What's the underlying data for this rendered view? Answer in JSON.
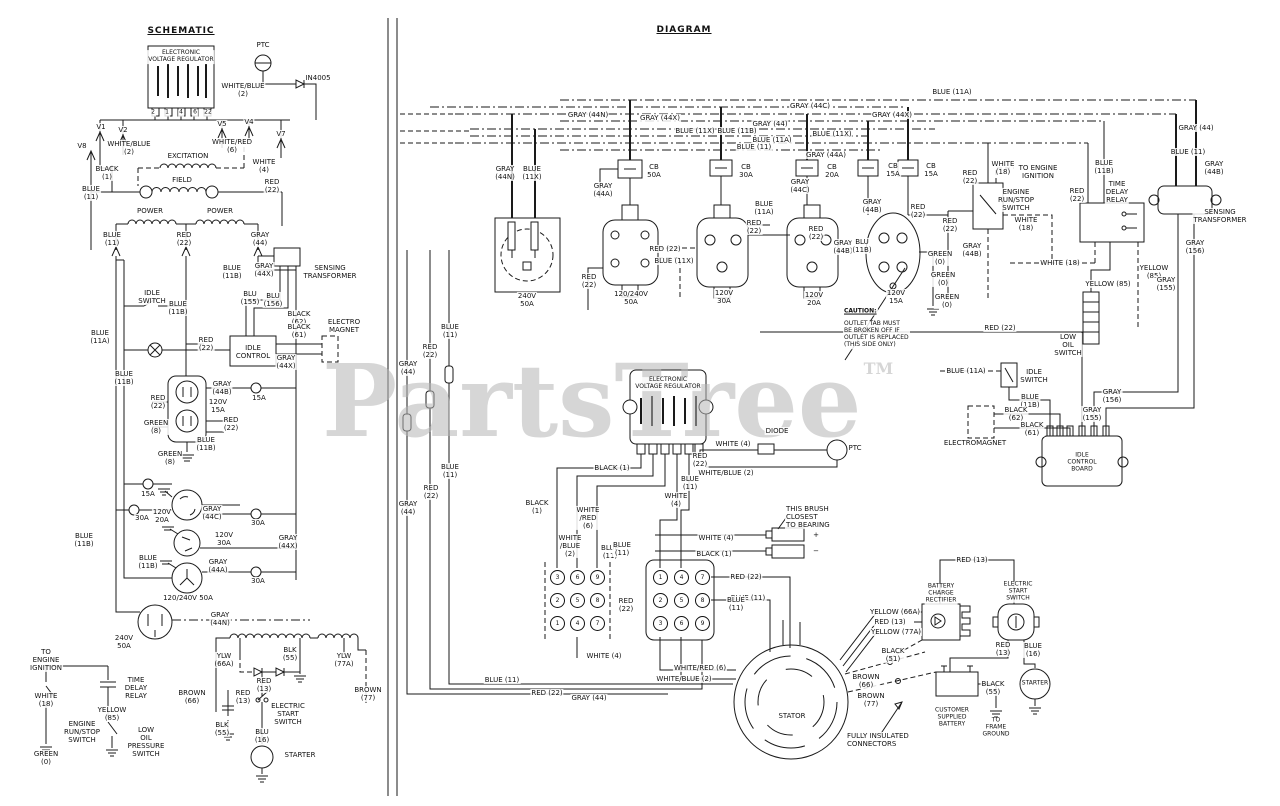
{
  "sections": {
    "schematic_title": "SCHEMATIC",
    "diagram_title": "DIAGRAM"
  },
  "watermark": {
    "text": "PartsTree",
    "tm": "TM",
    "color": "#b5b5b5"
  },
  "line_color": "#1a1a1a",
  "connector_grids": [
    {
      "x0": 557,
      "y0": 577,
      "dx": 20,
      "dy": 23,
      "values": [
        [
          "3",
          "6",
          "9"
        ],
        [
          "2",
          "5",
          "8"
        ],
        [
          "1",
          "4",
          "7"
        ]
      ]
    },
    {
      "x0": 660,
      "y0": 577,
      "dx": 21,
      "dy": 23,
      "values": [
        [
          "1",
          "4",
          "7"
        ],
        [
          "2",
          "5",
          "8"
        ],
        [
          "3",
          "6",
          "9"
        ]
      ]
    }
  ],
  "labels": [
    {
      "t": "ELECTRONIC\nVOLTAGE REGULATOR",
      "x": 181,
      "y": 57,
      "s": 1
    },
    {
      "t": "2",
      "x": 153,
      "y": 113,
      "s": 1
    },
    {
      "t": "1",
      "x": 167,
      "y": 113,
      "s": 1
    },
    {
      "t": "4",
      "x": 181,
      "y": 113,
      "s": 1
    },
    {
      "t": "6",
      "x": 195,
      "y": 113,
      "s": 1
    },
    {
      "t": "22",
      "x": 208,
      "y": 113,
      "s": 1
    },
    {
      "t": "PTC",
      "x": 263,
      "y": 45
    },
    {
      "t": "IN4005",
      "x": 318,
      "y": 78
    },
    {
      "t": "WHITE/BLUE\n(2)",
      "x": 243,
      "y": 90
    },
    {
      "t": "V1",
      "x": 101,
      "y": 127
    },
    {
      "t": "V2",
      "x": 123,
      "y": 130
    },
    {
      "t": "V5",
      "x": 222,
      "y": 124
    },
    {
      "t": "V4",
      "x": 249,
      "y": 122
    },
    {
      "t": "V7",
      "x": 281,
      "y": 134
    },
    {
      "t": "V8",
      "x": 82,
      "y": 146
    },
    {
      "t": "WHITE/BLUE\n(2)",
      "x": 129,
      "y": 148
    },
    {
      "t": "WHITE/RED\n(6)",
      "x": 232,
      "y": 146
    },
    {
      "t": "EXCITATION",
      "x": 188,
      "y": 156
    },
    {
      "t": "WHITE\n(4)",
      "x": 264,
      "y": 166
    },
    {
      "t": "BLACK\n(1)",
      "x": 107,
      "y": 173
    },
    {
      "t": "FIELD",
      "x": 182,
      "y": 180
    },
    {
      "t": "RED\n(22)",
      "x": 272,
      "y": 186
    },
    {
      "t": "BLUE\n(11)",
      "x": 91,
      "y": 193
    },
    {
      "t": "POWER",
      "x": 150,
      "y": 211
    },
    {
      "t": "POWER",
      "x": 220,
      "y": 211
    },
    {
      "t": "BLUE\n(11)",
      "x": 112,
      "y": 239
    },
    {
      "t": "RED\n(22)",
      "x": 184,
      "y": 239
    },
    {
      "t": "GRAY\n(44)",
      "x": 260,
      "y": 239
    },
    {
      "t": "BLUE\n(11B)",
      "x": 232,
      "y": 272
    },
    {
      "t": "GRAY\n(44X)",
      "x": 264,
      "y": 270
    },
    {
      "t": "SENSING\nTRANSFORMER",
      "x": 330,
      "y": 272
    },
    {
      "t": "IDLE\nSWITCH",
      "x": 152,
      "y": 297
    },
    {
      "t": "BLUE\n(11B)",
      "x": 178,
      "y": 308
    },
    {
      "t": "BLU\n(155)",
      "x": 250,
      "y": 298
    },
    {
      "t": "BLU\n(156)",
      "x": 273,
      "y": 300
    },
    {
      "t": "BLACK\n(62)",
      "x": 299,
      "y": 318
    },
    {
      "t": "BLACK\n(61)",
      "x": 299,
      "y": 331
    },
    {
      "t": "ELECTRO\nMAGNET",
      "x": 344,
      "y": 326
    },
    {
      "t": "BLUE\n(11A)",
      "x": 100,
      "y": 337
    },
    {
      "t": "RED\n(22)",
      "x": 206,
      "y": 344
    },
    {
      "t": "IDLE\nCONTROL",
      "x": 253,
      "y": 352
    },
    {
      "t": "GRAY\n(44X)",
      "x": 286,
      "y": 362
    },
    {
      "t": "BLUE\n(11B)",
      "x": 124,
      "y": 378
    },
    {
      "t": "GRAY\n(44B)",
      "x": 222,
      "y": 388
    },
    {
      "t": "RED\n(22)",
      "x": 158,
      "y": 402
    },
    {
      "t": "120V\n15A",
      "x": 218,
      "y": 406
    },
    {
      "t": "GREEN\n(8)",
      "x": 156,
      "y": 427
    },
    {
      "t": "RED\n(22)",
      "x": 231,
      "y": 424
    },
    {
      "t": "BLUE\n(11B)",
      "x": 206,
      "y": 444
    },
    {
      "t": "GREEN\n(8)",
      "x": 170,
      "y": 458
    },
    {
      "t": "15A",
      "x": 259,
      "y": 398
    },
    {
      "t": "15A",
      "x": 148,
      "y": 494
    },
    {
      "t": "30A",
      "x": 142,
      "y": 518
    },
    {
      "t": "30A",
      "x": 258,
      "y": 523
    },
    {
      "t": "30A",
      "x": 258,
      "y": 581
    },
    {
      "t": "120V\n20A",
      "x": 162,
      "y": 516
    },
    {
      "t": "GRAY\n(44C)",
      "x": 212,
      "y": 513
    },
    {
      "t": "GRAY\n(44X)",
      "x": 288,
      "y": 542
    },
    {
      "t": "120V\n30A",
      "x": 224,
      "y": 539
    },
    {
      "t": "BLUE\n(11B)",
      "x": 148,
      "y": 562
    },
    {
      "t": "GRAY\n(44A)",
      "x": 218,
      "y": 566
    },
    {
      "t": "120/240V 50A",
      "x": 188,
      "y": 598
    },
    {
      "t": "BLUE\n(11B)",
      "x": 84,
      "y": 540
    },
    {
      "t": "240V\n50A",
      "x": 124,
      "y": 642
    },
    {
      "t": "GRAY\n(44N)",
      "x": 220,
      "y": 619
    },
    {
      "t": "TO\nENGINE\nIGNITION",
      "x": 46,
      "y": 660
    },
    {
      "t": "YLW\n(66A)",
      "x": 224,
      "y": 660
    },
    {
      "t": "BLK\n(55)",
      "x": 290,
      "y": 654
    },
    {
      "t": "YLW\n(77A)",
      "x": 344,
      "y": 660
    },
    {
      "t": "WHITE\n(18)",
      "x": 46,
      "y": 700
    },
    {
      "t": "TIME\nDELAY\nRELAY",
      "x": 136,
      "y": 688
    },
    {
      "t": "YELLOW\n(85)",
      "x": 112,
      "y": 714
    },
    {
      "t": "ENGINE\nRUN/STOP\nSWITCH",
      "x": 82,
      "y": 732
    },
    {
      "t": "LOW\nOIL\nPRESSURE\nSWITCH",
      "x": 146,
      "y": 742
    },
    {
      "t": "GREEN\n(0)",
      "x": 46,
      "y": 758
    },
    {
      "t": "BROWN\n(66)",
      "x": 192,
      "y": 697
    },
    {
      "t": "RED\n(13)",
      "x": 243,
      "y": 697
    },
    {
      "t": "RED\n(13)",
      "x": 264,
      "y": 685
    },
    {
      "t": "ELECTRIC\nSTART\nSWITCH",
      "x": 288,
      "y": 714
    },
    {
      "t": "BLK\n(55)",
      "x": 222,
      "y": 729
    },
    {
      "t": "BLU\n(16)",
      "x": 262,
      "y": 736
    },
    {
      "t": "STARTER",
      "x": 300,
      "y": 755
    },
    {
      "t": "BROWN\n(77)",
      "x": 368,
      "y": 694
    },
    {
      "t": "GRAY (44N)",
      "x": 588,
      "y": 115
    },
    {
      "t": "GRAY (44X)",
      "x": 660,
      "y": 118
    },
    {
      "t": "GRAY (44C)",
      "x": 810,
      "y": 106
    },
    {
      "t": "GRAY (44)",
      "x": 770,
      "y": 124
    },
    {
      "t": "BLUE (11X)",
      "x": 695,
      "y": 131
    },
    {
      "t": "BLUE (11B)",
      "x": 737,
      "y": 131
    },
    {
      "t": "BLUE (11X)",
      "x": 832,
      "y": 134
    },
    {
      "t": "BLUE (11A)",
      "x": 772,
      "y": 140
    },
    {
      "t": "BLUE (11)",
      "x": 754,
      "y": 147
    },
    {
      "t": "GRAY (44X)",
      "x": 892,
      "y": 115
    },
    {
      "t": "BLUE (11A)",
      "x": 952,
      "y": 92
    },
    {
      "t": "GRAY (44A)",
      "x": 826,
      "y": 155
    },
    {
      "t": "GRAY\n(44N)",
      "x": 505,
      "y": 173
    },
    {
      "t": "BLUE\n(11X)",
      "x": 532,
      "y": 173
    },
    {
      "t": "CB\n50A",
      "x": 654,
      "y": 171
    },
    {
      "t": "CB\n30A",
      "x": 746,
      "y": 171
    },
    {
      "t": "CB\n20A",
      "x": 832,
      "y": 171
    },
    {
      "t": "CB\n15A",
      "x": 893,
      "y": 170
    },
    {
      "t": "CB\n15A",
      "x": 931,
      "y": 170
    },
    {
      "t": "GRAY\n(44C)",
      "x": 800,
      "y": 186
    },
    {
      "t": "GRAY\n(44A)",
      "x": 603,
      "y": 190
    },
    {
      "t": "BLUE\n(11A)",
      "x": 764,
      "y": 208
    },
    {
      "t": "RED\n(22)",
      "x": 754,
      "y": 227
    },
    {
      "t": "RED\n(22)",
      "x": 816,
      "y": 233
    },
    {
      "t": "GRAY\n(44B)",
      "x": 872,
      "y": 206
    },
    {
      "t": "RED\n(22)",
      "x": 918,
      "y": 211
    },
    {
      "t": "GRAY\n(44B)",
      "x": 843,
      "y": 247
    },
    {
      "t": "BLU\n(11B)",
      "x": 862,
      "y": 246
    },
    {
      "t": "RED\n(22)",
      "x": 950,
      "y": 225
    },
    {
      "t": "GREEN\n(0)",
      "x": 940,
      "y": 258
    },
    {
      "t": "GREEN\n(0)",
      "x": 943,
      "y": 279
    },
    {
      "t": "GREEN\n(0)",
      "x": 947,
      "y": 301
    },
    {
      "t": "120V\n30A",
      "x": 724,
      "y": 297
    },
    {
      "t": "120V\n20A",
      "x": 814,
      "y": 299
    },
    {
      "t": "120V\n15A",
      "x": 896,
      "y": 297
    },
    {
      "t": "240V\n50A",
      "x": 527,
      "y": 300
    },
    {
      "t": "120/240V\n50A",
      "x": 631,
      "y": 298
    },
    {
      "t": "RED\n(22)",
      "x": 589,
      "y": 281
    },
    {
      "t": "RED (22)",
      "x": 665,
      "y": 249
    },
    {
      "t": "BLUE (11X)",
      "x": 674,
      "y": 261
    },
    {
      "t": "RED (22)",
      "x": 1000,
      "y": 328
    },
    {
      "t": "CAUTION:",
      "x": 843,
      "y": 312,
      "a": "l",
      "u": 1,
      "s": 1
    },
    {
      "t": "OUTLET TAB MUST\nBE BROKEN OFF IF\nOUTLET IS REPLACED\n(THIS SIDE ONLY)",
      "x": 843,
      "y": 335,
      "a": "l",
      "s": 1
    },
    {
      "t": "RED\n(22)",
      "x": 970,
      "y": 177
    },
    {
      "t": "WHITE\n(18)",
      "x": 1003,
      "y": 168
    },
    {
      "t": "TO ENGINE\nIGNITION",
      "x": 1038,
      "y": 172
    },
    {
      "t": "ENGINE\nRUN/STOP\nSWITCH",
      "x": 1016,
      "y": 200
    },
    {
      "t": "WHITE\n(18)",
      "x": 1026,
      "y": 224
    },
    {
      "t": "GRAY\n(44B)",
      "x": 972,
      "y": 250
    },
    {
      "t": "BLUE\n(11B)",
      "x": 1104,
      "y": 167
    },
    {
      "t": "GRAY (44)",
      "x": 1196,
      "y": 128
    },
    {
      "t": "BLUE (11)",
      "x": 1188,
      "y": 152
    },
    {
      "t": "GRAY\n(44B)",
      "x": 1214,
      "y": 168
    },
    {
      "t": "RED\n(22)",
      "x": 1077,
      "y": 195
    },
    {
      "t": "TIME\nDELAY\nRELAY",
      "x": 1117,
      "y": 192
    },
    {
      "t": "WHITE (18)",
      "x": 1060,
      "y": 263
    },
    {
      "t": "YELLOW (85)",
      "x": 1108,
      "y": 284
    },
    {
      "t": "YELLOW\n(85)",
      "x": 1154,
      "y": 272
    },
    {
      "t": "SENSING\nTRANSFORMER",
      "x": 1220,
      "y": 216
    },
    {
      "t": "GRAY\n(156)",
      "x": 1195,
      "y": 247
    },
    {
      "t": "GRAY\n(155)",
      "x": 1166,
      "y": 284
    },
    {
      "t": "LOW\nOIL\nSWITCH",
      "x": 1068,
      "y": 345
    },
    {
      "t": "BLUE (11A)",
      "x": 966,
      "y": 371
    },
    {
      "t": "IDLE\nSWITCH",
      "x": 1034,
      "y": 376
    },
    {
      "t": "BLUE\n(11B)",
      "x": 1030,
      "y": 401
    },
    {
      "t": "BLACK\n(62)",
      "x": 1016,
      "y": 414
    },
    {
      "t": "BLACK\n(61)",
      "x": 1032,
      "y": 429
    },
    {
      "t": "ELECTROMAGNET",
      "x": 975,
      "y": 443
    },
    {
      "t": "GRAY\n(155)",
      "x": 1092,
      "y": 414
    },
    {
      "t": "GRAY\n(156)",
      "x": 1112,
      "y": 396
    },
    {
      "t": "IDLE\nCONTROL\nBOARD",
      "x": 1082,
      "y": 463,
      "s": 1
    },
    {
      "t": "ELECTRONIC\nVOLTAGE REGULATOR",
      "x": 668,
      "y": 384,
      "s": 1
    },
    {
      "t": "DIODE",
      "x": 777,
      "y": 431
    },
    {
      "t": "WHITE (4)",
      "x": 733,
      "y": 444
    },
    {
      "t": "PTC",
      "x": 855,
      "y": 448
    },
    {
      "t": "RED\n(22)",
      "x": 700,
      "y": 460
    },
    {
      "t": "WHITE/BLUE (2)",
      "x": 726,
      "y": 473
    },
    {
      "t": "BLACK (1)",
      "x": 612,
      "y": 468
    },
    {
      "t": "BLUE\n(11)",
      "x": 690,
      "y": 483
    },
    {
      "t": "WHITE\n(4)",
      "x": 676,
      "y": 500
    },
    {
      "t": "BLUE\n(11)",
      "x": 610,
      "y": 552
    },
    {
      "t": "THIS BRUSH\nCLOSEST\nTO BEARING",
      "x": 785,
      "y": 517,
      "a": "l"
    },
    {
      "t": "WHITE (4)",
      "x": 716,
      "y": 538
    },
    {
      "t": "BLACK (1)",
      "x": 714,
      "y": 554
    },
    {
      "t": "+",
      "x": 816,
      "y": 535
    },
    {
      "t": "−",
      "x": 816,
      "y": 551
    },
    {
      "t": "BLACK\n(1)",
      "x": 537,
      "y": 507
    },
    {
      "t": "WHITE\n/RED\n(6)",
      "x": 588,
      "y": 518
    },
    {
      "t": "WHITE\n/BLUE\n(2)",
      "x": 570,
      "y": 546
    },
    {
      "t": "BLUE\n(11)",
      "x": 622,
      "y": 549
    },
    {
      "t": "RED\n(22)",
      "x": 626,
      "y": 605
    },
    {
      "t": "WHITE (4)",
      "x": 604,
      "y": 656
    },
    {
      "t": "RED (22)",
      "x": 746,
      "y": 577
    },
    {
      "t": "BLUE (11)",
      "x": 748,
      "y": 598
    },
    {
      "t": "WHITE/RED (6)",
      "x": 700,
      "y": 668
    },
    {
      "t": "WHITE/BLUE (2)",
      "x": 684,
      "y": 679
    },
    {
      "t": "BLUE (11)",
      "x": 502,
      "y": 680
    },
    {
      "t": "RED (22)",
      "x": 547,
      "y": 693
    },
    {
      "t": "GRAY (44)",
      "x": 589,
      "y": 698
    },
    {
      "t": "GRAY\n(44)",
      "x": 408,
      "y": 368
    },
    {
      "t": "RED\n(22)",
      "x": 430,
      "y": 351
    },
    {
      "t": "BLUE\n(11)",
      "x": 450,
      "y": 331
    },
    {
      "t": "GRAY\n(44)",
      "x": 408,
      "y": 508
    },
    {
      "t": "RED\n(22)",
      "x": 431,
      "y": 492
    },
    {
      "t": "BLUE\n(11)",
      "x": 450,
      "y": 471
    },
    {
      "t": "BLUE\n(11)",
      "x": 736,
      "y": 604
    },
    {
      "t": "STATOR",
      "x": 792,
      "y": 716
    },
    {
      "t": "YELLOW (66A)",
      "x": 895,
      "y": 612
    },
    {
      "t": "RED (13)",
      "x": 890,
      "y": 622
    },
    {
      "t": "YELLOW (77A)",
      "x": 896,
      "y": 632
    },
    {
      "t": "BATTERY\nCHARGE\nRECTIFIER",
      "x": 941,
      "y": 594,
      "s": 1
    },
    {
      "t": "BLACK\n(51)",
      "x": 893,
      "y": 655
    },
    {
      "t": "RED (13)",
      "x": 972,
      "y": 560
    },
    {
      "t": "ELECTRIC\nSTART\nSWITCH",
      "x": 1018,
      "y": 592,
      "s": 1
    },
    {
      "t": "RED\n(13)",
      "x": 1003,
      "y": 649
    },
    {
      "t": "BLUE\n(16)",
      "x": 1033,
      "y": 650
    },
    {
      "t": "STARTER",
      "x": 1035,
      "y": 684,
      "s": 1
    },
    {
      "t": "CUSTOMER\nSUPPLIED\nBATTERY",
      "x": 952,
      "y": 718,
      "s": 1
    },
    {
      "t": "BLACK\n(55)",
      "x": 993,
      "y": 688
    },
    {
      "t": "TO\nFRAME\nGROUND",
      "x": 996,
      "y": 728,
      "s": 1
    },
    {
      "t": "BROWN\n(66)",
      "x": 866,
      "y": 681
    },
    {
      "t": "BROWN\n(77)",
      "x": 871,
      "y": 700
    },
    {
      "t": "FULLY INSULATED\nCONNECTORS",
      "x": 846,
      "y": 740,
      "a": "l"
    }
  ]
}
